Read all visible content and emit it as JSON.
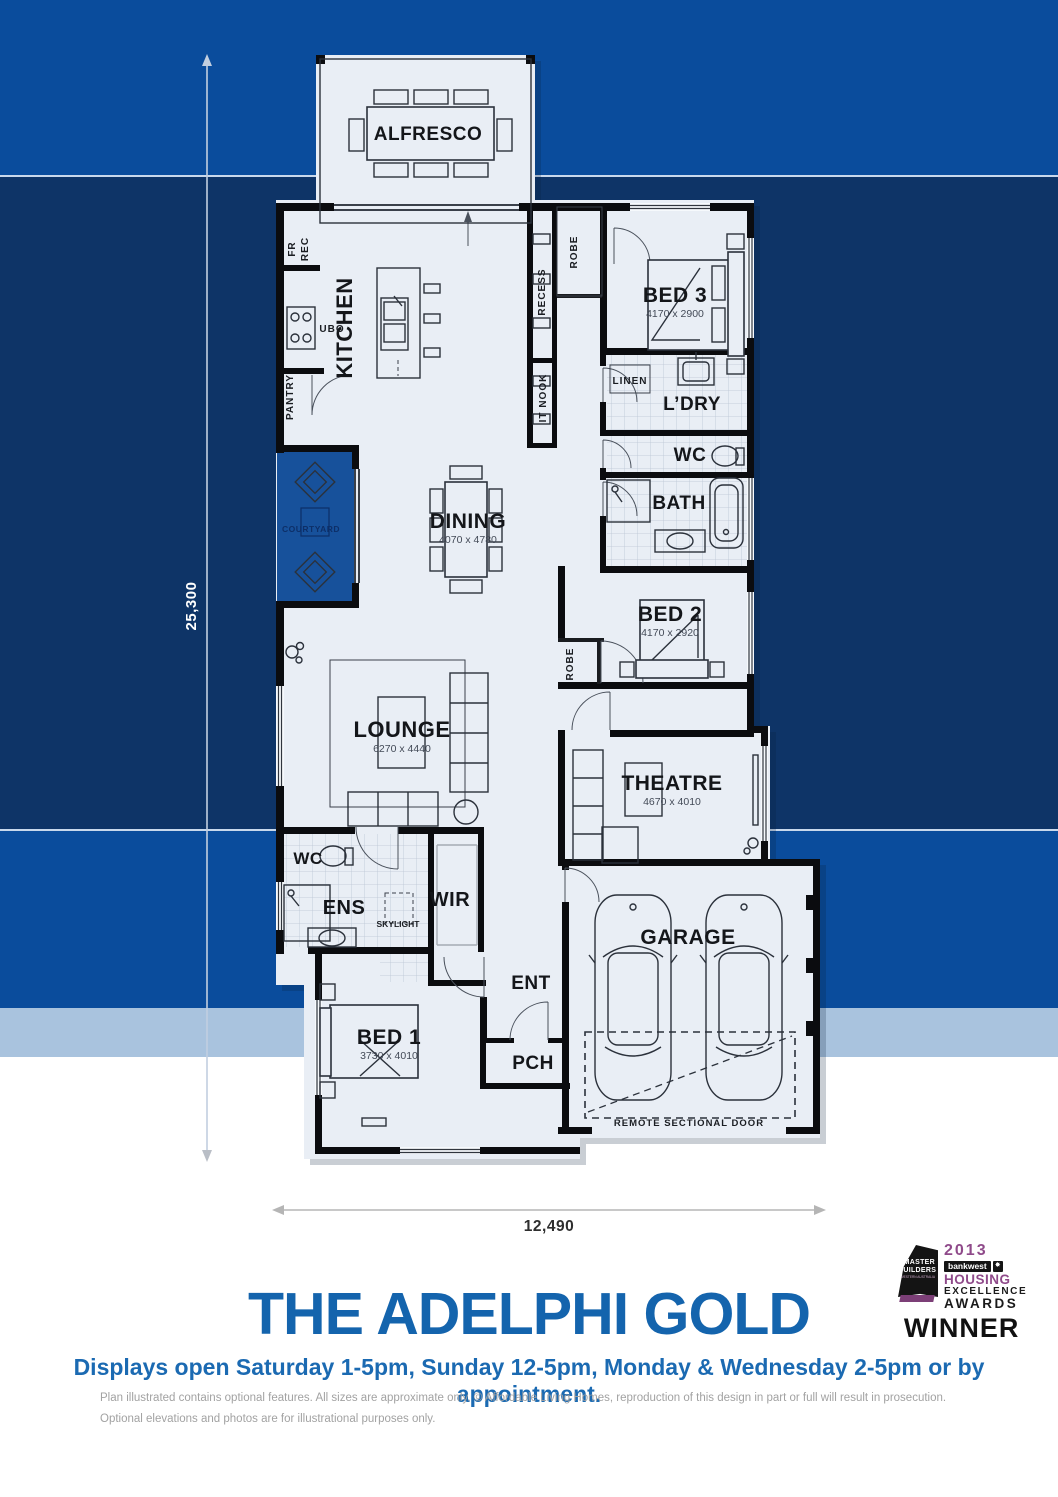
{
  "colors": {
    "band_blue": "#0a4c9c",
    "band_navy": "#0e3467",
    "band_steel": "#a9c3de",
    "plan_background": "#e9eef5",
    "wall_black": "#0b0c0f",
    "courtyard_blue": "#17519b",
    "title_blue": "#1464ad",
    "badge_purple": "#8f4a8a"
  },
  "dimensions": {
    "vertical": "25,300",
    "horizontal": "12,490"
  },
  "rooms": {
    "alfresco": {
      "label": "ALFRESCO"
    },
    "kitchen": {
      "label": "KITCHEN"
    },
    "fr": {
      "label": "FR"
    },
    "rec": {
      "label": "REC"
    },
    "ubo": {
      "label": "UBO"
    },
    "pantry": {
      "label": "PANTRY"
    },
    "recess": {
      "label": "RECESS"
    },
    "it_nook": {
      "label": "IT NOOK"
    },
    "robe_bed3": {
      "label": "ROBE"
    },
    "bed3": {
      "label": "BED 3",
      "dims": "4170 x 2900"
    },
    "linen": {
      "label": "LINEN"
    },
    "ldry": {
      "label": "L’DRY"
    },
    "wc": {
      "label": "WC"
    },
    "bath": {
      "label": "BATH"
    },
    "bed2": {
      "label": "BED 2",
      "dims": "4170 x 2920"
    },
    "robe_bed2": {
      "label": "ROBE"
    },
    "dining": {
      "label": "DINING",
      "dims": "4070 x 4780"
    },
    "courtyard": {
      "label": "COURTYARD"
    },
    "lounge": {
      "label": "LOUNGE",
      "dims": "6270 x 4440"
    },
    "theatre": {
      "label": "THEATRE",
      "dims": "4670 x 4010"
    },
    "wc_ens": {
      "label": "WC"
    },
    "ens": {
      "label": "ENS"
    },
    "skylight": {
      "label": "SKYLIGHT"
    },
    "wir": {
      "label": "WIR"
    },
    "bed1": {
      "label": "BED 1",
      "dims": "3730 x 4010"
    },
    "ent": {
      "label": "ENT"
    },
    "pch": {
      "label": "PCH"
    },
    "garage": {
      "label": "GARAGE"
    },
    "remote_door": {
      "label": "REMOTE SECTIONAL DOOR"
    }
  },
  "footer": {
    "title": "THE ADELPHI GOLD",
    "subtitle": "Displays open Saturday 1-5pm, Sunday 12-5pm, Monday & Wednesday 2-5pm or by appointment.",
    "fine_print_line1": "Plan illustrated contains optional features. All sizes are approximate only. © Affordable Living Homes, reproduction of this design in part or full will result in prosecution.",
    "fine_print_line2": "Optional elevations and photos are for illustrational purposes only."
  },
  "badge": {
    "year": "2013",
    "sponsor": "bankwest",
    "line1": "HOUSING",
    "line2": "EXCELLENCE",
    "line3": "AWARDS",
    "line4": "WINNER",
    "org_line1": "MASTER",
    "org_line2": "BUILDERS",
    "org_line3": "WESTERN AUSTRALIA"
  }
}
